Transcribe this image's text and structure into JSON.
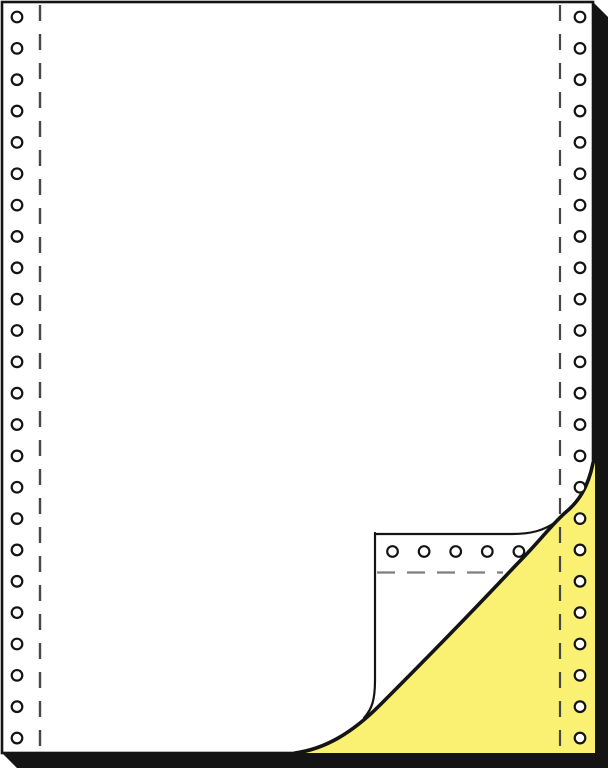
{
  "meta": {
    "description": "Product illustration of continuous tractor-feed printer paper; top white sheet with sprocket-hole margins and dashed perforation lines, bottom corner curled back revealing a yellow carbonless copy sheet",
    "sheet_count_visible": 2
  },
  "colors": {
    "background": "#ffffff",
    "paper_white": "#ffffff",
    "outline_black": "#141414",
    "stack_shadow": "#141414",
    "copy_sheet_yellow": "#FAF172",
    "perforation_dash": "#474747",
    "flap_perforation_dash": "#7d7d7d",
    "hole_fill": "#ffffff",
    "hole_ring": "#141414"
  },
  "canvas": {
    "width": 608,
    "height": 768
  },
  "paper": {
    "x": 2,
    "y": 2,
    "width": 591,
    "height": 751,
    "outline_width": 2.6
  },
  "shadow": {
    "path": "M 593 2 L 608 17 L 608 768 L 17 768 L 2 753 L 593 753 Z"
  },
  "copy_sheet": {
    "fill_path": "M 593 463 C 588 488 578 502 566 512 C 553 523 538 543 517 564 C 470 614 425 660 380 705 C 352 733 325 749 295 753 L 595 753 L 595 463 Z"
  },
  "fold": {
    "curl_path": "M 295 753 C 325 749 352 733 380 705 C 425 660 470 614 517 564 C 538 543 553 523 566 512 C 578 502 588 488 593 463",
    "curl_width": 3.6,
    "flap_top_edge_path": "M 375 534 L 512 534 C 530 534 544 531 557 521",
    "flap_left_edge_path": "M 375 533 L 375 680 C 375 700 372 709 364 718",
    "flap_edge_width": 2.2
  },
  "sprocket_holes": {
    "outer_radius": 5.3,
    "ring_width": 2.2,
    "left_column": {
      "x": 17,
      "start_y": 17,
      "spacing": 31.35,
      "count": 24
    },
    "right_column": {
      "x": 580,
      "start_y": 17,
      "spacing": 31.35,
      "count": 24
    },
    "flap_row": {
      "y": 551.5,
      "start_x": 392.5,
      "spacing": 31.6,
      "count": 5
    }
  },
  "perforation_lines": {
    "left": {
      "x": 40,
      "y1": 5,
      "y2": 751,
      "dash": 16,
      "gap": 13,
      "width": 2.4
    },
    "right": {
      "x": 560,
      "y1": 5,
      "y2": 751,
      "dash": 16,
      "gap": 13,
      "width": 2.2
    },
    "flap": {
      "y": 572.5,
      "x1": 377,
      "x2": 503,
      "dash": 18,
      "gap": 12,
      "width": 2.2
    }
  }
}
